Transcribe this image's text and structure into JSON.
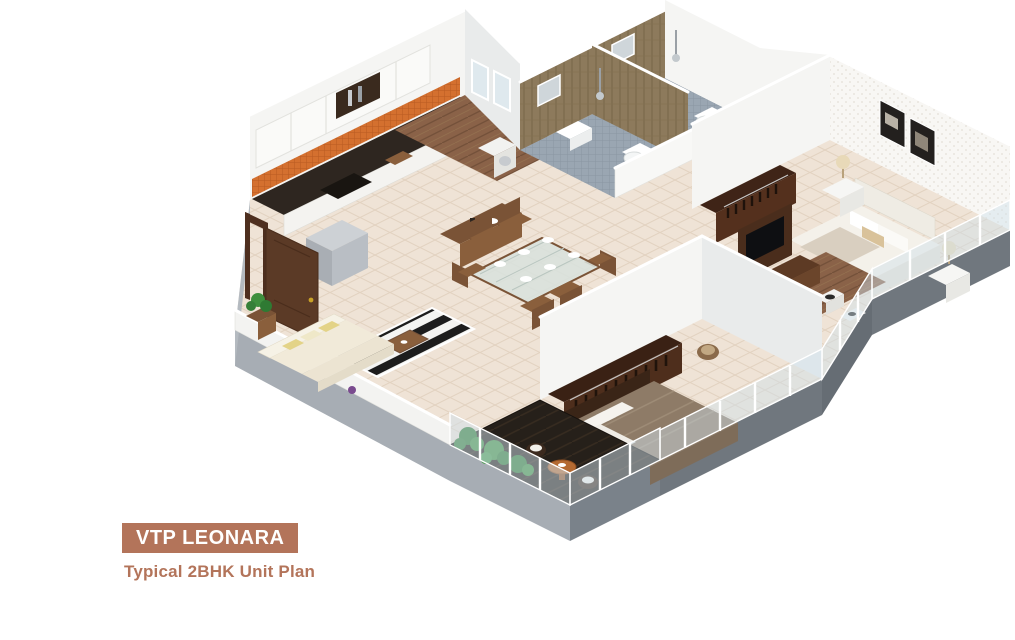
{
  "page": {
    "background": "#ffffff"
  },
  "badge": {
    "label": "VTP LEONARA",
    "background": "#b3745a",
    "color": "#ffffff"
  },
  "subtitle": {
    "label": "Typical 2BHK Unit Plan",
    "color": "#b3745a"
  },
  "plan": {
    "kind": "isometric 3D floor plan render",
    "unit_type": "2BHK",
    "rooms": [
      {
        "id": "kitchen",
        "name": "Kitchen"
      },
      {
        "id": "foyer",
        "name": "Foyer / Utility"
      },
      {
        "id": "bathroom-1",
        "name": "Bathroom 1"
      },
      {
        "id": "bathroom-2",
        "name": "Bathroom 2"
      },
      {
        "id": "master-bedroom",
        "name": "Master Bedroom"
      },
      {
        "id": "living-room",
        "name": "Living Room"
      },
      {
        "id": "dining-area",
        "name": "Dining Area"
      },
      {
        "id": "bedroom-2",
        "name": "Bedroom 2"
      },
      {
        "id": "balcony",
        "name": "Balcony Deck"
      },
      {
        "id": "hall-tv-area",
        "name": "TV / Passage Area"
      }
    ],
    "colors": {
      "floorTile": "#efe3d6",
      "woodFloor": "#8a6248",
      "bathTileWall": "#8d7a5c",
      "bathFloor": "#9aa6b2",
      "kitchenBacksplash": "#d4702f",
      "wall": "#f5f5f3",
      "plinthLight": "#a7adb4",
      "plinthDark": "#70777e",
      "doorWood": "#5b3a26",
      "wardrobeWood": "#46281a",
      "deck": "#26201a",
      "plant": "#3e8f3e",
      "glass": "#cfe0ea",
      "sofa": "#f1ead9",
      "accentPillow": "#e3d387",
      "bedLinen": "#f4f1ea",
      "bed2Linen": "#8e7b67",
      "counter": "#2e2620",
      "tableWood": "#8a5f3c"
    }
  }
}
